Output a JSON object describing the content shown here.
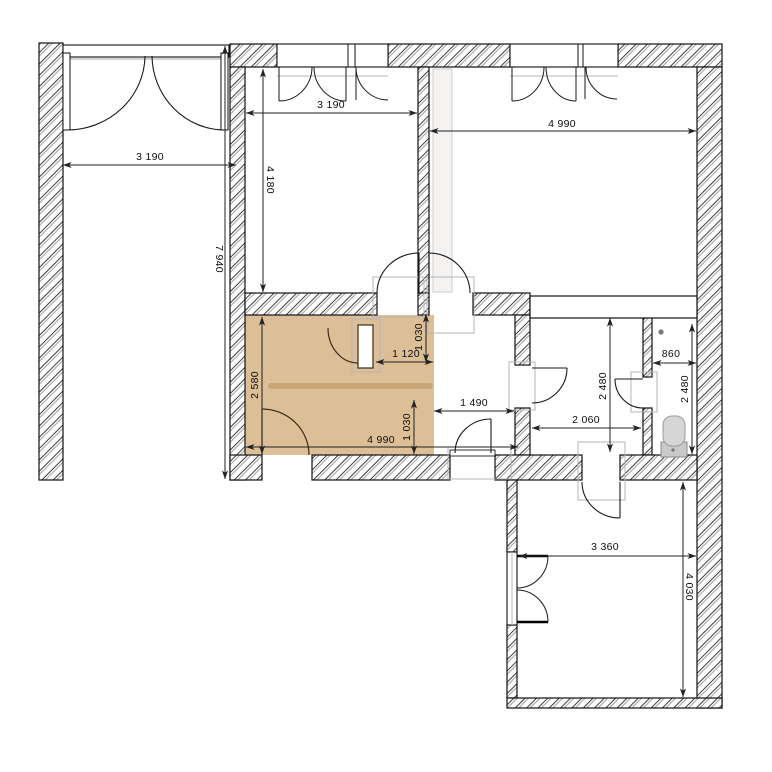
{
  "drawing": {
    "type": "architectural-floor-plan",
    "units": "mm",
    "highlighted_room_dimensions": [
      "4 990",
      "2 580"
    ],
    "fixtures": [
      "toilet"
    ]
  },
  "colors": {
    "highlight_room_fill": "#dcbf97",
    "highlight_room_stripe": "#c8a679",
    "wall_hatch_dark": "#3d3d3d",
    "wall_hatch_light": "#ababab",
    "wall_outline": "#111111",
    "door_arc_dark": "#1a1a1a",
    "door_arc_brown": "#3c2c18",
    "frame_gray": "#b5b5b5",
    "glass_gray": "#b9b9b9",
    "fixture_gray": "#d6d6d6",
    "dim_line": "#222222",
    "dim_text": "#0d0d0d"
  },
  "dimensions": [
    {
      "id": "dim-patio-width",
      "text": "3 190",
      "x": 150,
      "y": 157,
      "rot": 0
    },
    {
      "id": "dim-patio-length",
      "text": "7 940",
      "x": 219,
      "y": 259,
      "rot": 90
    },
    {
      "id": "dim-room2-width",
      "text": "3 190",
      "x": 331,
      "y": 105,
      "rot": 0
    },
    {
      "id": "dim-room2-depth",
      "text": "4 180",
      "x": 270,
      "y": 180,
      "rot": 90
    },
    {
      "id": "dim-room3-width",
      "text": "4 990",
      "x": 562,
      "y": 124,
      "rot": 0
    },
    {
      "id": "dim-kitchen-opening-a",
      "text": "1 030",
      "x": 419,
      "y": 337,
      "rot": 270
    },
    {
      "id": "dim-kitchen-door",
      "text": "1 120",
      "x": 406,
      "y": 354,
      "rot": 0
    },
    {
      "id": "dim-kitchen-depth",
      "text": "2 580",
      "x": 255,
      "y": 385,
      "rot": 270
    },
    {
      "id": "dim-kitchen-opening-b",
      "text": "1 030",
      "x": 407,
      "y": 427,
      "rot": 270
    },
    {
      "id": "dim-kitchen-width",
      "text": "4 990",
      "x": 381,
      "y": 440,
      "rot": 0
    },
    {
      "id": "dim-hall-width",
      "text": "1 490",
      "x": 474,
      "y": 403,
      "rot": 0
    },
    {
      "id": "dim-bath-width",
      "text": "2 060",
      "x": 586,
      "y": 420,
      "rot": 0
    },
    {
      "id": "dim-bath-depth",
      "text": "2 480",
      "x": 603,
      "y": 386,
      "rot": 270
    },
    {
      "id": "dim-wc-width",
      "text": "860",
      "x": 671,
      "y": 354,
      "rot": 0
    },
    {
      "id": "dim-wc-depth",
      "text": "2 480",
      "x": 685,
      "y": 389,
      "rot": 270
    },
    {
      "id": "dim-bottomroom-width",
      "text": "3 360",
      "x": 605,
      "y": 547,
      "rot": 0
    },
    {
      "id": "dim-bottomroom-depth",
      "text": "4 030",
      "x": 689,
      "y": 587,
      "rot": 90
    }
  ]
}
